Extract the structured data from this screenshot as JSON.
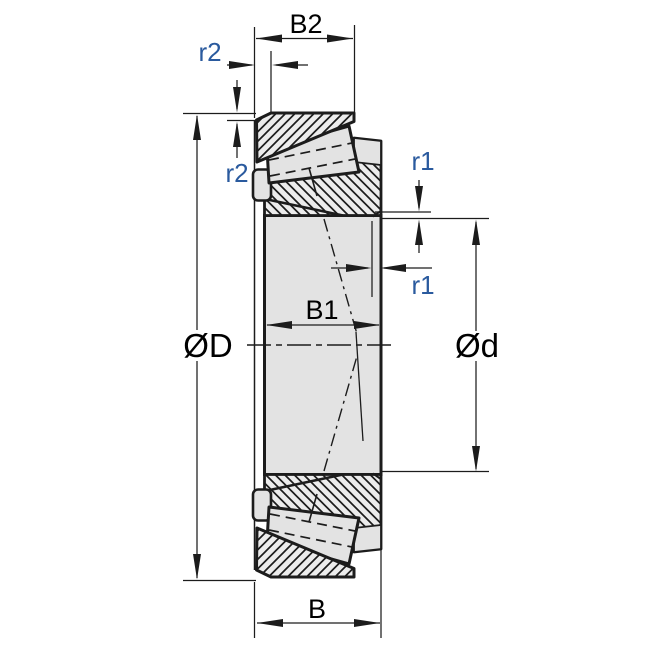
{
  "figure": {
    "title": "Tapered roller bearing cross-section technical drawing",
    "background": "#ffffff",
    "colors": {
      "line": "#1c1c1c",
      "part_fill": "#e3e3e3",
      "hatch_fill": "#ececec",
      "dim_text": "#000000",
      "radius_text": "#2a5a9e"
    },
    "dimensions": {
      "b2": "B2",
      "r2_top": "r2",
      "r2_side": "r2",
      "outer_dia": "ØD",
      "b1": "B1",
      "r1_top": "r1",
      "r1_side": "r1",
      "bore_dia": "Ød",
      "b": "B"
    }
  }
}
